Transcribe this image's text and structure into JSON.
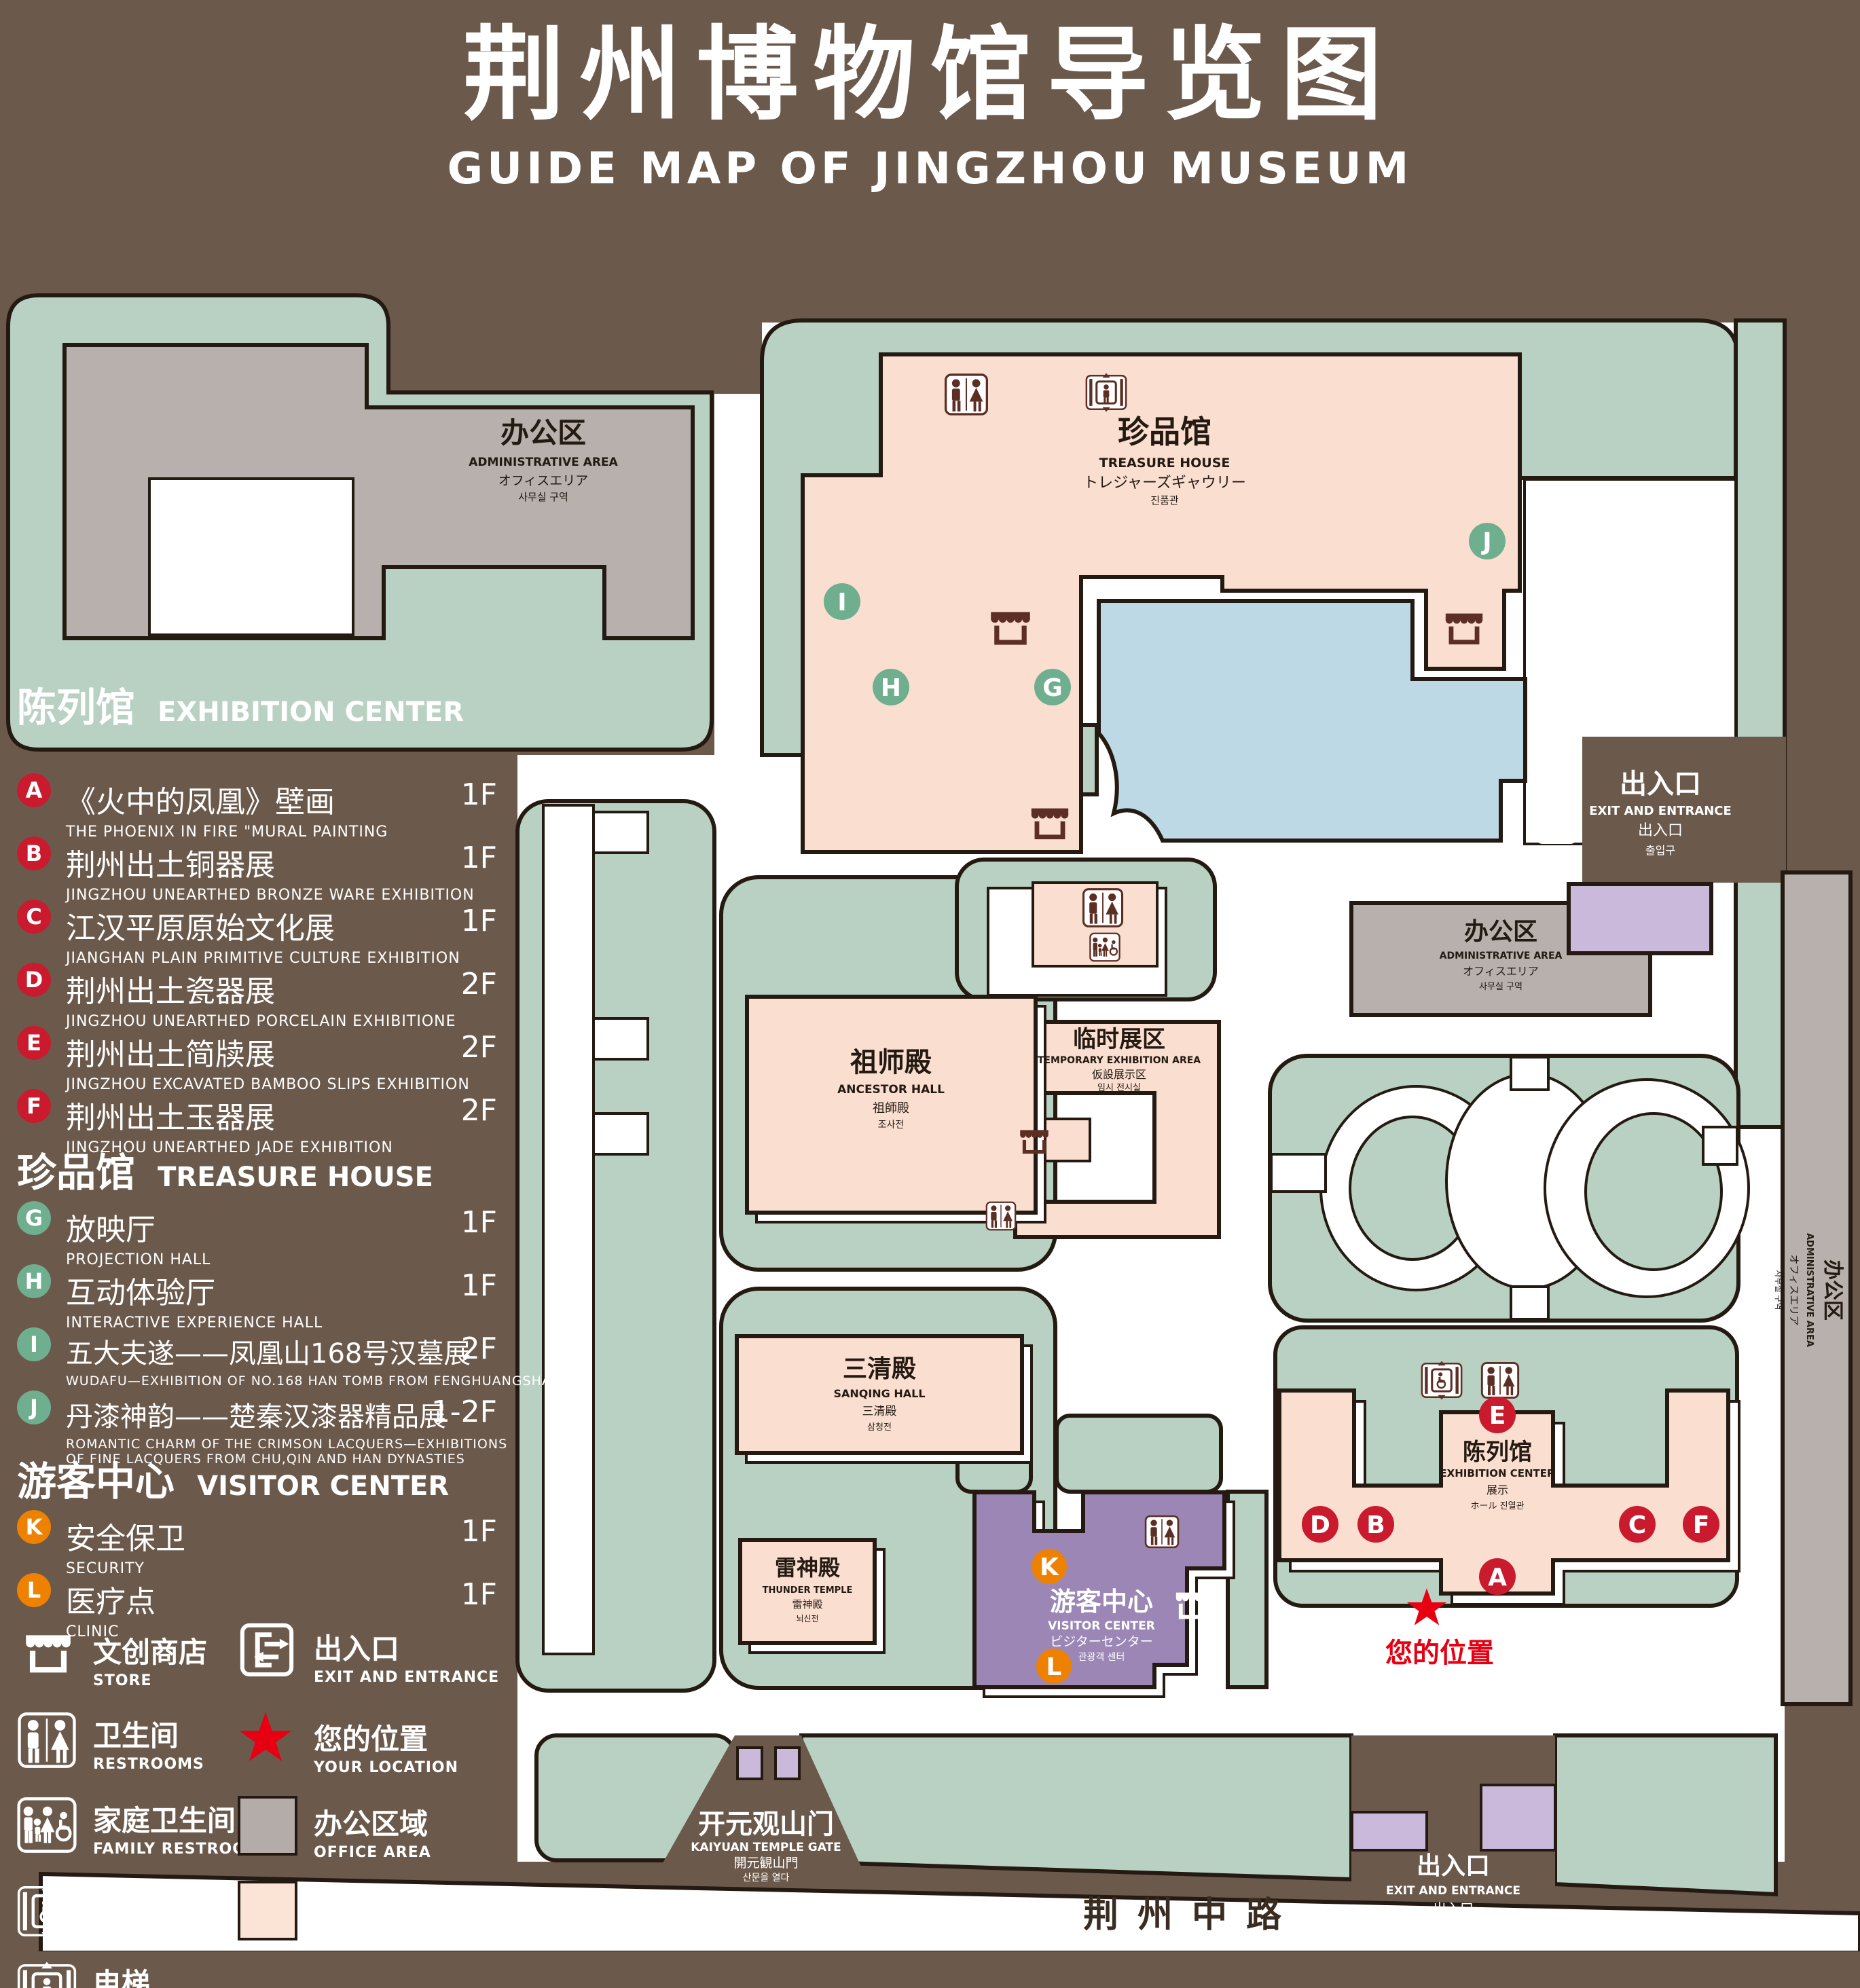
{
  "title": {
    "cn": "荆州博物馆导览图",
    "en": "GUIDE MAP OF JINGZHOU MUSEUM"
  },
  "marker_letters": [
    "A",
    "B",
    "C",
    "D",
    "E",
    "F",
    "G",
    "H",
    "I",
    "J",
    "K",
    "L"
  ],
  "legend": {
    "sections": [
      {
        "cn": "陈列馆",
        "en": "EXHIBITION CENTER"
      },
      {
        "cn": "珍品馆",
        "en": "TREASURE HOUSE"
      },
      {
        "cn": "游客中心",
        "en": "VISITOR CENTER"
      }
    ],
    "items": [
      {
        "code": "A",
        "cn": "《火中的凤凰》壁画",
        "en": "THE PHOENIX IN FIRE \"MURAL PAINTING",
        "floor": "1F"
      },
      {
        "code": "B",
        "cn": "荆州出土铜器展",
        "en": "JINGZHOU UNEARTHED BRONZE WARE EXHIBITION",
        "floor": "1F"
      },
      {
        "code": "C",
        "cn": "江汉平原原始文化展",
        "en": "JIANGHAN PLAIN PRIMITIVE CULTURE EXHIBITION",
        "floor": "1F"
      },
      {
        "code": "D",
        "cn": "荆州出土瓷器展",
        "en": "JINGZHOU UNEARTHED PORCELAIN EXHIBITIONE",
        "floor": "2F"
      },
      {
        "code": "E",
        "cn": "荆州出土简牍展",
        "en": "JINGZHOU EXCAVATED BAMBOO SLIPS EXHIBITION",
        "floor": "2F"
      },
      {
        "code": "F",
        "cn": "荆州出土玉器展",
        "en": "JINGZHOU UNEARTHED JADE EXHIBITION",
        "floor": "2F"
      },
      {
        "code": "G",
        "cn": "放映厅",
        "en": "PROJECTION HALL",
        "floor": "1F"
      },
      {
        "code": "H",
        "cn": "互动体验厅",
        "en": "INTERACTIVE EXPERIENCE HALL",
        "floor": "1F"
      },
      {
        "code": "I",
        "cn": "五大夫遂——凤凰山168号汉墓展",
        "en": "WUDAFU—EXHIBITION OF NO.168 HAN TOMB FROM FENGHUANGSHAN",
        "floor": "2F"
      },
      {
        "code": "J",
        "cn": "丹漆神韵——楚秦汉漆器精品展",
        "en": "ROMANTIC CHARM OF THE CRIMSON LACQUERS—EXHIBITIONS",
        "en2": "OF FINE LACQUERS FROM CHU,QIN AND HAN DYNASTIES",
        "floor": "1-2F"
      },
      {
        "code": "K",
        "cn": "安全保卫",
        "en": "SECURITY",
        "floor": "1F"
      },
      {
        "code": "L",
        "cn": "医疗点",
        "en": "CLINIC",
        "floor": "1F"
      }
    ],
    "icons": {
      "store": {
        "cn": "文创商店",
        "en": "STORE"
      },
      "exit": {
        "cn": "出入口",
        "en": "EXIT AND ENTRANCE"
      },
      "restroom": {
        "cn": "卫生间",
        "en": "RESTROOMS"
      },
      "location": {
        "cn": "您的位置",
        "en": "YOUR LOCATION"
      },
      "family": {
        "cn": "家庭卫生间",
        "en": "FAMILY RESTROOMS"
      },
      "office": {
        "cn": "办公区域",
        "en": "OFFICE AREA"
      },
      "accessible": {
        "cn": "无障碍电梯",
        "en": "ACCESSIBLE ELEVATOR"
      },
      "display": {
        "cn": "展示区域",
        "en": "DISPLAY AREA"
      },
      "elevator": {
        "cn": "电梯",
        "en": "Elevator"
      }
    }
  },
  "map": {
    "admin_nw": {
      "cn": "办公区",
      "en": "ADMINISTRATIVE AREA",
      "jp": "オフィスエリア",
      "kr": "사무실 구역"
    },
    "admin_e": {
      "cn": "办公区",
      "en": "ADMINISTRATIVE AREA",
      "jp": "オフィスエリア",
      "kr": "사무실 구역"
    },
    "admin_side": {
      "cn": "办公区",
      "en": "ADMINISTRATIVE AREA",
      "jp": "オフィスエリア",
      "kr": "사무실 구역"
    },
    "treasure_house": {
      "cn": "珍品馆",
      "en": "TREASURE HOUSE",
      "jp": "トレジャーズギャウリー",
      "kr": "진품관"
    },
    "ancestor_hall": {
      "cn": "祖师殿",
      "en": "ANCESTOR HALL",
      "jp": "祖師殿",
      "kr": "조사전"
    },
    "sanqing_hall": {
      "cn": "三清殿",
      "en": "SANQING HALL",
      "jp": "三清殿",
      "kr": "삼청전"
    },
    "thunder_temple": {
      "cn": "雷神殿",
      "en": "THUNDER TEMPLE",
      "jp": "雷神殿",
      "kr": "뇌신전"
    },
    "temporary": {
      "cn": "临时展区",
      "en": "TEMPORARY EXHIBITION AREA",
      "jp": "仮設展示区",
      "kr": "임시 전시실"
    },
    "visitor_center": {
      "cn": "游客中心",
      "en": "VISITOR CENTER",
      "jp": "ビジターセンター",
      "kr": "관광객 센터"
    },
    "exhibition_center": {
      "cn": "陈列馆",
      "en": "EXHIBITION CENTER",
      "jp": "展示",
      "kr": "ホール 진열관"
    },
    "gate": {
      "cn": "开元观山门",
      "en": "KAIYUAN TEMPLE GATE",
      "jp": "開元観山門",
      "kr": "산문을 열다"
    },
    "exit_east": {
      "cn": "出入口",
      "en": "EXIT AND ENTRANCE",
      "jp": "出入口",
      "kr": "출입구"
    },
    "exit_south": {
      "cn": "出入口",
      "en": "EXIT AND ENTRANCE",
      "jp": "出入口",
      "kr": "출입구"
    },
    "your_location": "您的位置",
    "road": "荆州中路"
  },
  "colors": {
    "background": "#6b5a4c",
    "green": "#b9d1c2",
    "pink": "#fadfd1",
    "gray": "#b7b0ac",
    "pond_blue": "#bdd9e6",
    "purple": "#9b86b6",
    "light_purple": "#cbb9db",
    "maroon": "#5d2f24",
    "badge_red": "#c91a2e",
    "badge_green": "#6fae8e",
    "badge_orange": "#ee8100",
    "star_red": "#e60012"
  }
}
